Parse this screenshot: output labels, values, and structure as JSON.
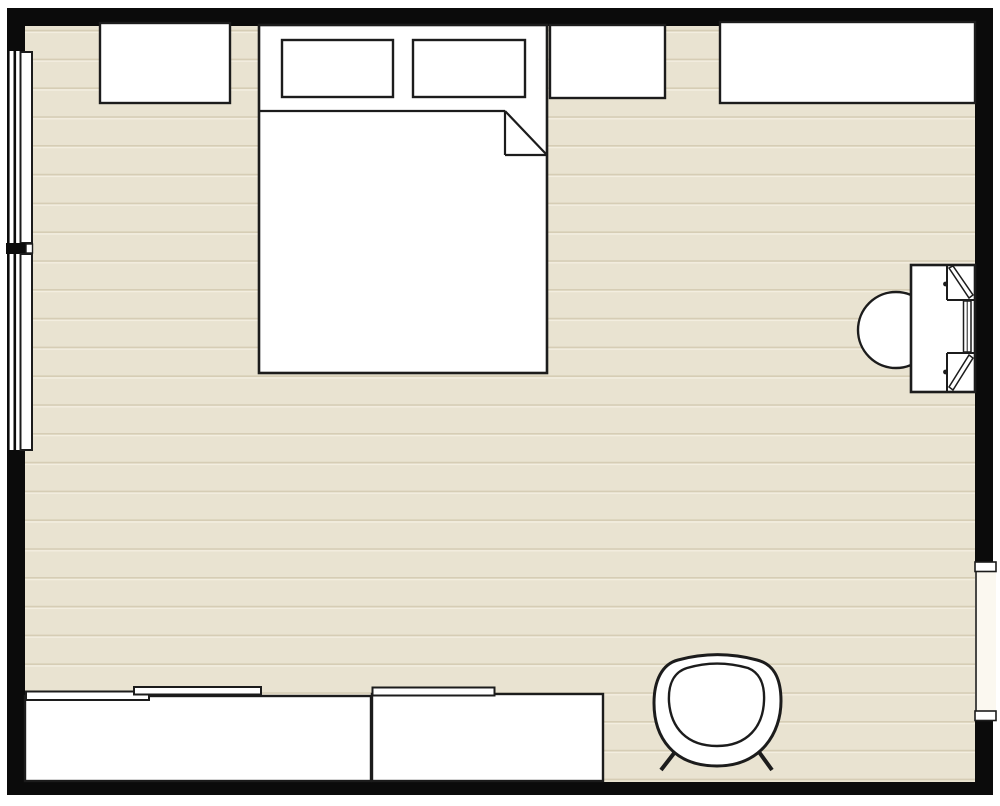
{
  "meta": {
    "title": "bedroom-floor-plan",
    "canvas_w": 1000,
    "canvas_h": 806
  },
  "palette": {
    "canvas": "#ffffff",
    "wall": "#0b0b0b",
    "floor": "#e9e3d1",
    "plank_dark": "#d6cdb5",
    "plank_light": "#f3eee0",
    "outline": "#1c1c1c",
    "white": "#ffffff",
    "opening": "#fbf8f0"
  },
  "scene": [
    {
      "name": "outer-walls",
      "interactable": false,
      "shapes": [
        {
          "kind": "rect",
          "x": 7,
          "y": 8,
          "w": 986,
          "h": 787,
          "fill": "wall"
        }
      ]
    },
    {
      "name": "floor",
      "interactable": false,
      "shapes": [
        {
          "kind": "rect",
          "x": 25,
          "y": 26,
          "w": 950,
          "h": 756,
          "fill": "floor"
        },
        {
          "kind": "hlines",
          "x": 25,
          "w": 950,
          "y0": 30.6,
          "y1": 781,
          "spacing": 28.8,
          "stroke": "plank_dark",
          "sw": 1.6
        },
        {
          "kind": "hlines",
          "x": 25,
          "w": 950,
          "y0": 32.4,
          "y1": 781,
          "spacing": 28.8,
          "stroke": "plank_light",
          "sw": 1.4
        }
      ]
    },
    {
      "name": "window-opening-left",
      "interactable": false,
      "shapes": [
        {
          "kind": "rect",
          "x": 6,
          "y": 51,
          "w": 20,
          "h": 399,
          "fill": "white"
        }
      ]
    },
    {
      "name": "window-upper-left",
      "interactable": true,
      "shapes": [
        {
          "kind": "rect",
          "x": 7,
          "y": 51,
          "w": 2.6,
          "h": 192,
          "fill": "wall"
        },
        {
          "kind": "rect",
          "x": 13.5,
          "y": 51,
          "w": 2.6,
          "h": 192,
          "fill": "wall"
        },
        {
          "kind": "rect",
          "x": 20.5,
          "y": 52,
          "w": 11.5,
          "h": 191,
          "fill": "white",
          "stroke": "outline",
          "sw": 2
        }
      ]
    },
    {
      "name": "wall-pier-left",
      "interactable": false,
      "shapes": [
        {
          "kind": "rect",
          "x": 6,
          "y": 243,
          "w": 20,
          "h": 11,
          "fill": "wall"
        },
        {
          "kind": "rect",
          "x": 26,
          "y": 244,
          "w": 6.5,
          "h": 9,
          "fill": "white",
          "stroke": "outline",
          "sw": 1.4
        }
      ]
    },
    {
      "name": "window-lower-left",
      "interactable": true,
      "shapes": [
        {
          "kind": "rect",
          "x": 7,
          "y": 254,
          "w": 2.6,
          "h": 196,
          "fill": "wall"
        },
        {
          "kind": "rect",
          "x": 13.5,
          "y": 254,
          "w": 2.6,
          "h": 196,
          "fill": "wall"
        },
        {
          "kind": "rect",
          "x": 20.5,
          "y": 254,
          "w": 11.5,
          "h": 196,
          "fill": "white",
          "stroke": "outline",
          "sw": 2
        }
      ]
    },
    {
      "name": "door-opening-right",
      "interactable": true,
      "shapes": [
        {
          "kind": "rect",
          "x": 975,
          "y": 571,
          "w": 21,
          "h": 141,
          "fill": "opening"
        },
        {
          "kind": "line",
          "x1": 976,
          "y1": 565,
          "x2": 976,
          "y2": 718,
          "stroke": "outline",
          "sw": 1.6
        },
        {
          "kind": "rect",
          "x": 975,
          "y": 562,
          "w": 21,
          "h": 9.5,
          "fill": "white",
          "stroke": "outline",
          "sw": 1.6
        },
        {
          "kind": "rect",
          "x": 975,
          "y": 711,
          "w": 21,
          "h": 9.5,
          "fill": "white",
          "stroke": "outline",
          "sw": 1.6
        }
      ]
    },
    {
      "name": "nightstand-left",
      "interactable": true,
      "shapes": [
        {
          "kind": "rect",
          "x": 100,
          "y": 23,
          "w": 130,
          "h": 80,
          "fill": "white",
          "stroke": "outline",
          "sw": 2.4
        }
      ]
    },
    {
      "name": "bed",
      "interactable": true,
      "shapes": [
        {
          "kind": "rect",
          "x": 259,
          "y": 25,
          "w": 288,
          "h": 348,
          "fill": "white",
          "stroke": "outline",
          "sw": 2.6
        },
        {
          "kind": "rect",
          "x": 282,
          "y": 40,
          "w": 111,
          "h": 57,
          "fill": "white",
          "stroke": "outline",
          "sw": 2.4
        },
        {
          "kind": "rect",
          "x": 413,
          "y": 40,
          "w": 112,
          "h": 57,
          "fill": "white",
          "stroke": "outline",
          "sw": 2.4
        },
        {
          "kind": "line",
          "x1": 259,
          "y1": 111,
          "x2": 505,
          "y2": 111,
          "stroke": "outline",
          "sw": 2.2
        },
        {
          "kind": "line",
          "x1": 505,
          "y1": 111,
          "x2": 505,
          "y2": 155,
          "stroke": "outline",
          "sw": 2.2
        },
        {
          "kind": "line",
          "x1": 505,
          "y1": 155,
          "x2": 546,
          "y2": 155,
          "stroke": "outline",
          "sw": 2.2
        },
        {
          "kind": "line",
          "x1": 505,
          "y1": 111,
          "x2": 546,
          "y2": 154,
          "stroke": "outline",
          "sw": 2.2
        }
      ]
    },
    {
      "name": "nightstand-right",
      "interactable": true,
      "shapes": [
        {
          "kind": "rect",
          "x": 550,
          "y": 25,
          "w": 115,
          "h": 73,
          "fill": "white",
          "stroke": "outline",
          "sw": 2.4
        }
      ]
    },
    {
      "name": "dresser",
      "interactable": true,
      "shapes": [
        {
          "kind": "rect",
          "x": 720,
          "y": 22,
          "w": 255,
          "h": 81,
          "fill": "white",
          "stroke": "outline",
          "sw": 2.4
        }
      ]
    },
    {
      "name": "vanity-stool",
      "interactable": true,
      "shapes": [
        {
          "kind": "circle",
          "cx": 896,
          "cy": 330,
          "r": 38,
          "fill": "white",
          "stroke": "outline",
          "sw": 2.4
        }
      ]
    },
    {
      "name": "vanity-desk",
      "interactable": true,
      "shapes": [
        {
          "kind": "rect",
          "x": 911,
          "y": 265,
          "w": 64,
          "h": 127,
          "fill": "white",
          "stroke": "outline",
          "sw": 2.6
        },
        {
          "kind": "line",
          "x1": 947,
          "y1": 265,
          "x2": 947,
          "y2": 300,
          "stroke": "outline",
          "sw": 2
        },
        {
          "kind": "line",
          "x1": 947,
          "y1": 300,
          "x2": 975,
          "y2": 300,
          "stroke": "outline",
          "sw": 2
        },
        {
          "kind": "line",
          "x1": 947,
          "y1": 353,
          "x2": 975,
          "y2": 353,
          "stroke": "outline",
          "sw": 2
        },
        {
          "kind": "line",
          "x1": 947,
          "y1": 353,
          "x2": 947,
          "y2": 392,
          "stroke": "outline",
          "sw": 2
        },
        {
          "kind": "path",
          "d": "M949,268 L953,266 L973,295 L969,298 Z",
          "fill": "white",
          "stroke": "outline",
          "sw": 1.5
        },
        {
          "kind": "path",
          "d": "M969,355 L973,358 L953,390 L949,387 Z",
          "fill": "white",
          "stroke": "outline",
          "sw": 1.5
        },
        {
          "kind": "rect",
          "x": 963.5,
          "y": 301,
          "w": 7.5,
          "h": 51,
          "fill": "white",
          "stroke": "outline",
          "sw": 1.5
        },
        {
          "kind": "line",
          "x1": 967.2,
          "y1": 301,
          "x2": 967.2,
          "y2": 352,
          "stroke": "outline",
          "sw": 1
        },
        {
          "kind": "circle",
          "cx": 945.5,
          "cy": 284,
          "r": 2.4,
          "fill": "outline"
        },
        {
          "kind": "circle",
          "cx": 945.5,
          "cy": 372,
          "r": 2.4,
          "fill": "outline"
        }
      ]
    },
    {
      "name": "wardrobe-left",
      "interactable": true,
      "shapes": [
        {
          "kind": "rect",
          "x": 25,
          "y": 696,
          "w": 346,
          "h": 85,
          "fill": "white",
          "stroke": "outline",
          "sw": 2.4
        },
        {
          "kind": "rect",
          "x": 26,
          "y": 691.5,
          "w": 123,
          "h": 8.5,
          "fill": "white",
          "stroke": "outline",
          "sw": 2
        },
        {
          "kind": "rect",
          "x": 134,
          "y": 687,
          "w": 127,
          "h": 7.5,
          "fill": "white",
          "stroke": "outline",
          "sw": 2
        }
      ]
    },
    {
      "name": "wardrobe-right",
      "interactable": true,
      "shapes": [
        {
          "kind": "rect",
          "x": 372,
          "y": 694,
          "w": 231,
          "h": 87,
          "fill": "white",
          "stroke": "outline",
          "sw": 2.4
        },
        {
          "kind": "rect",
          "x": 372.5,
          "y": 687.5,
          "w": 122,
          "h": 8,
          "fill": "white",
          "stroke": "outline",
          "sw": 2
        }
      ]
    },
    {
      "name": "armchair",
      "interactable": true,
      "shapes": [
        {
          "kind": "line",
          "x1": 675,
          "y1": 752,
          "x2": 661,
          "y2": 770,
          "stroke": "outline",
          "sw": 4
        },
        {
          "kind": "line",
          "x1": 759,
          "y1": 752,
          "x2": 772,
          "y2": 770,
          "stroke": "outline",
          "sw": 4
        },
        {
          "kind": "path",
          "d": "M 678,660 C 662,664 654,681 654,703 C 654,737 673,766 717,766 C 761,766 781,733 781,701 C 781,677 773,664 757,660 C 731,653 704,653 678,660 Z",
          "fill": "white",
          "stroke": "outline",
          "sw": 3
        },
        {
          "kind": "path",
          "d": "M 687,668 C 674,672 668,684 669,702 C 671,728 687,746 717,746 C 748,746 763,726 764,701 C 765,682 758,672 748,668 C 727,662 707,662 687,668 Z",
          "fill": "white",
          "stroke": "outline",
          "sw": 2.4
        }
      ]
    }
  ]
}
